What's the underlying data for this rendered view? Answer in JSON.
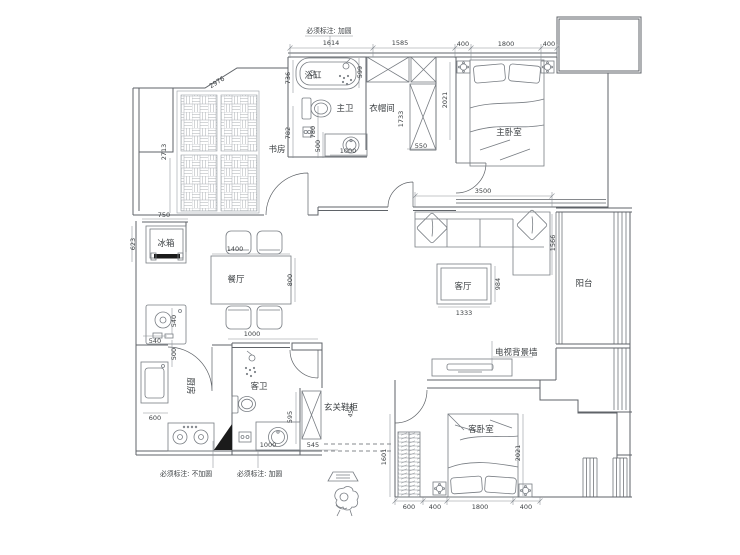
{
  "plan": {
    "notes": {
      "top": "必须标注: 加圆",
      "bottom_left": "必须标注: 不加圆",
      "bottom_mid": "必须标注: 加圆"
    },
    "rooms": {
      "study": "书房",
      "bathtub": "浴缸",
      "master_bath": "主卫",
      "closet": "衣帽间",
      "master_bedroom": "主卧室",
      "dining": "餐厅",
      "living": "客厅",
      "balcony": "阳台",
      "kitchen": "厨房",
      "guest_bath": "客卫",
      "entry_cabinet": "玄关鞋柜",
      "guest_bedroom": "客卧室",
      "fridge": "冰箱",
      "tv_wall": "电视背景墙"
    },
    "dims": {
      "d1614": "1614",
      "d1585": "1585",
      "d400a": "400",
      "d1800a": "1800",
      "d400b": "400",
      "d736": "736",
      "d599": "599",
      "d782": "782",
      "d780": "780",
      "d500a": "500",
      "d1000a": "1000",
      "d2976": "2976",
      "d2713": "2713",
      "d1733": "1733",
      "d550": "550",
      "d2021a": "2021",
      "d3500": "3500",
      "d1566": "1566",
      "d1333": "1333",
      "d984": "984",
      "d750": "750",
      "d623": "623",
      "d1400": "1400",
      "d800": "800",
      "d540a": "540",
      "d540b": "540",
      "d500b": "500",
      "d600a": "600",
      "d1000b": "1000",
      "d595": "595",
      "d1000c": "1000",
      "d545": "545",
      "d450": "450",
      "d1601": "1601",
      "d600b": "600",
      "d400c": "400",
      "d1800b": "1800",
      "d400d": "400",
      "d2021b": "2021"
    },
    "colors": {
      "wall_line": "#5f6368",
      "dim_line": "#8a9096",
      "text": "#3c4043",
      "paper": "#ffffff"
    }
  }
}
